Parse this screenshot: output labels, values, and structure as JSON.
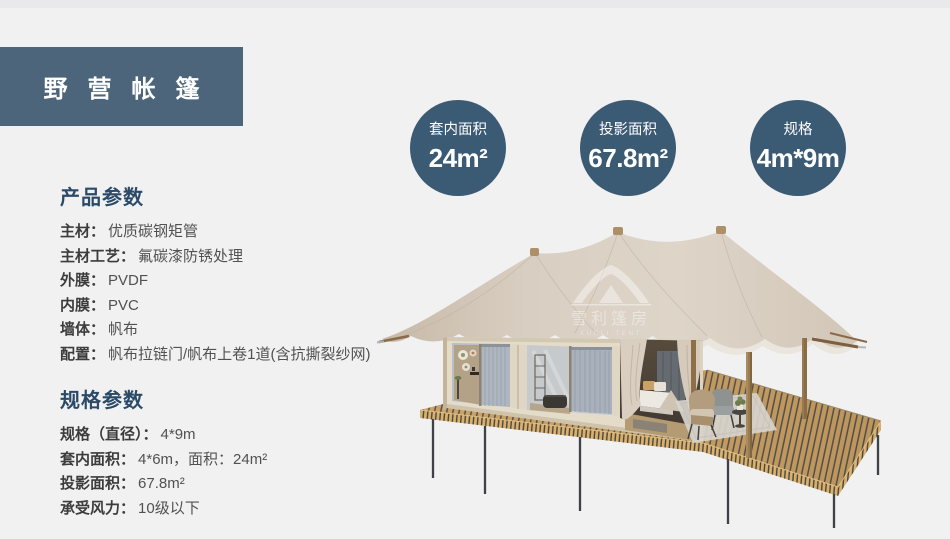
{
  "header": {
    "title": "野营帐篷"
  },
  "stats": [
    {
      "label": "套内面积",
      "value": "24m²"
    },
    {
      "label": "投影面积",
      "value": "67.8m²"
    },
    {
      "label": "规格",
      "value": "4m*9m"
    }
  ],
  "product_section": {
    "heading": "产品参数",
    "rows": [
      {
        "label": "主材：",
        "value": "优质碳钢矩管"
      },
      {
        "label": "主材工艺：",
        "value": "氟碳漆防锈处理"
      },
      {
        "label": "外膜：",
        "value": "PVDF"
      },
      {
        "label": "内膜：",
        "value": "PVC"
      },
      {
        "label": "墙体：",
        "value": "帆布"
      },
      {
        "label": "配置：",
        "value": "帆布拉链门/帆布上卷1道(含抗撕裂纱网)"
      }
    ]
  },
  "spec_section": {
    "heading": "规格参数",
    "rows": [
      {
        "label": "规格（直径）：",
        "value": "4*9m"
      },
      {
        "label": "套内面积：",
        "value": "4*6m，面积：24m²"
      },
      {
        "label": "投影面积：",
        "value": "67.8m²"
      },
      {
        "label": "承受风力：",
        "value": "10级以下"
      }
    ]
  },
  "watermark": {
    "text": "雪利篷房",
    "subtext": "XUELI TENT"
  },
  "colors": {
    "background": "#f1f1f2",
    "title_panel": "#4d657b",
    "stat_circle": "#3b5a74",
    "heading_blue": "#2b4a68",
    "canopy_beige": "#d7ccbf",
    "deck_wood": "#cda263"
  }
}
